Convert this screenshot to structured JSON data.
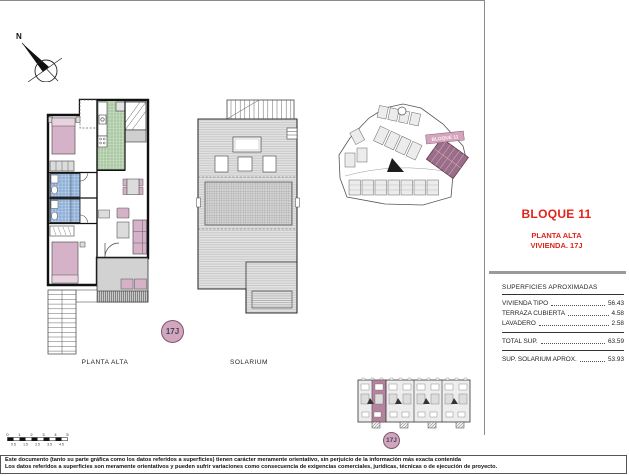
{
  "compass": {
    "north": "N"
  },
  "floor_plan": {
    "label": "PLANTA ALTA",
    "badge": "17J"
  },
  "solarium_plan": {
    "label": "SOLARIUM"
  },
  "site_plan": {
    "highlight_label": "BLOQUE 11"
  },
  "key_plan": {
    "badge": "17J"
  },
  "title_block": {
    "title": "BLOQUE 11",
    "subtitle1": "PLANTA ALTA",
    "subtitle2": "VIVIENDA. 17J",
    "table": {
      "header": "SUPERFICIES APROXIMADAS",
      "rows": [
        {
          "label": "VIVIENDA TIPO",
          "value": "56.43"
        },
        {
          "label": "TERRAZA CUBIERTA",
          "value": "4.58"
        },
        {
          "label": "LAVADERO",
          "value": "2.58"
        }
      ],
      "total_label": "TOTAL SUP.",
      "total_value": "63.59",
      "solarium_label": "SUP. SOLARIUM APROX.",
      "solarium_value": "53.93"
    }
  },
  "scale_bar": {
    "major": [
      "0",
      "1",
      "2",
      "3",
      "4",
      "5"
    ],
    "minor": [
      "0.5",
      "1.5",
      "2.5",
      "3.5",
      "4.5"
    ]
  },
  "footer": {
    "line1": "Este documento (tanto su parte gráfica como los datos referidos a superficies) tienen carácter meramente orientativo, sin perjuicio de la información más exacta contenida",
    "line2": "Los datos referidos a superficies son meramente orientativos y pueden sufrir variaciones como consecuencia de exigencias comerciales, jurídicas, técnicas o de ejecución de proyecto."
  },
  "colors": {
    "accent_red": "#e2231a",
    "furniture_pink": "#d6b2c8",
    "badge_pink": "#d2a7be",
    "site_highlight": "#9c6d88",
    "bath_blue": "#8fb1d9",
    "kitchen_green": "#abc9a3",
    "floor_gray": "#d2d2d2",
    "rule_gray": "#9a9a9a"
  }
}
